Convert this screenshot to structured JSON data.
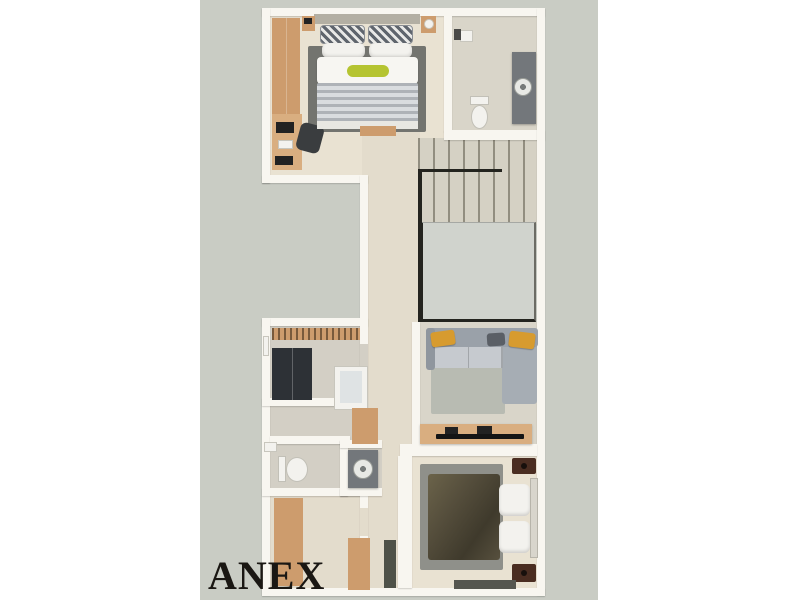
{
  "plan": {
    "label": "ANEX",
    "palette": {
      "page_bg": "#ffffff",
      "plan_bg": "#c9ccc4",
      "wall": "#f8f6f0",
      "floor_beige": "#e9e2d2",
      "floor_warm": "#e3dccc",
      "floor_concrete": "#d9d5c9",
      "floor_gray": "#d3cfc5",
      "stairs_bg": "#d5d1c4",
      "void_gray": "#d0d3cd",
      "railing": "#24241f",
      "wood": "#cd9c6d",
      "wood_light": "#d9ae80",
      "dark_wardrobe": "#2d3136",
      "sofa_back": "#9aa1a9",
      "sofa_seat": "#c6cacf",
      "mustard": "#d79b2f",
      "lime": "#b5c431",
      "rug_dark": "#73746f",
      "rug_mid": "#8f908a",
      "rug_light": "#b8bbb2",
      "stripe_dark": "#aeb2b7",
      "stripe_light": "#d9dcdf",
      "duvet_olive": "#554e3c",
      "nightstand_brown": "#4a2d21",
      "vanity_gray": "#73777b",
      "fixture_white": "#f3f2ee",
      "label_color": "#1a1713"
    }
  }
}
